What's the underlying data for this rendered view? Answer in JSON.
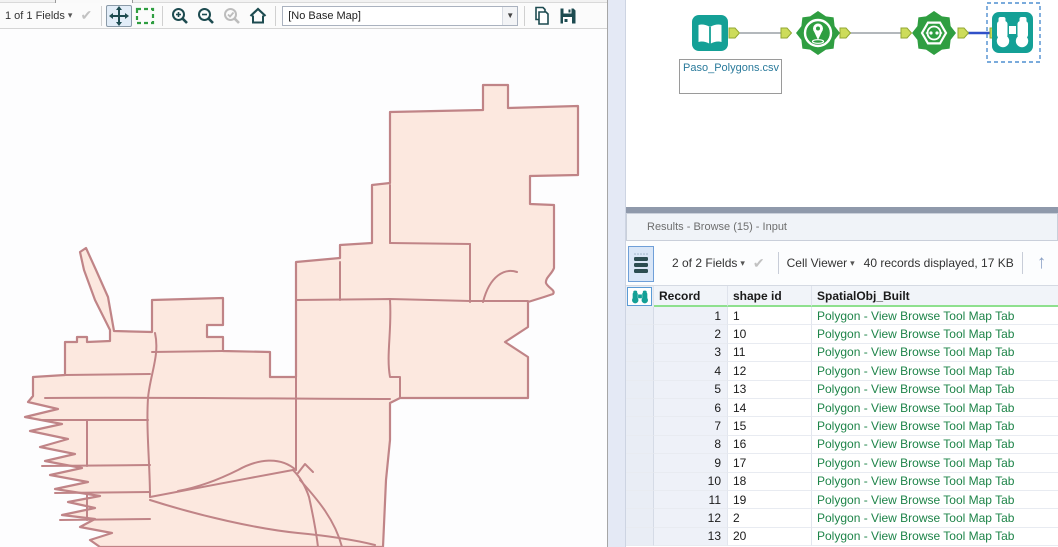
{
  "map_panel": {
    "toolbar": {
      "fields_label": "1 of 1 Fields",
      "caret": "▾",
      "check": "✔",
      "basemap_value": "[No Base Map]"
    },
    "colors": {
      "polygon_fill": "#fce8df",
      "polygon_stroke": "#c08487"
    }
  },
  "workflow": {
    "annotation": {
      "text": "Paso_Polygons.csv"
    },
    "icons": [
      "book-icon",
      "map-pin-icon",
      "poly-build-icon",
      "binoculars-icon"
    ],
    "colors": {
      "tool_teal": "#14a096",
      "tool_green": "#2f9e41",
      "anchor_fill": "#cddc5a",
      "anchor_stroke": "#93a732",
      "connection_gray": "#9aa0a6",
      "connection_blue": "#3050c8",
      "selection_blue": "#4f8fd0"
    }
  },
  "results": {
    "title": "Results - Browse (15) - Input",
    "toolbar": {
      "fields_label": "2 of 2 Fields",
      "caret": "▾",
      "check": "✔",
      "cell_viewer_label": "Cell Viewer",
      "records_info": "40 records displayed, 17 KB",
      "up_arrow": "↑"
    },
    "table": {
      "columns": [
        "Record",
        "shape id",
        "SpatialObj_Built"
      ],
      "spatial_text": "Polygon - View Browse Tool Map Tab",
      "link_color": "#1e8449",
      "rows": [
        {
          "record": "1",
          "shape_id": "1"
        },
        {
          "record": "2",
          "shape_id": "10"
        },
        {
          "record": "3",
          "shape_id": "11"
        },
        {
          "record": "4",
          "shape_id": "12"
        },
        {
          "record": "5",
          "shape_id": "13"
        },
        {
          "record": "6",
          "shape_id": "14"
        },
        {
          "record": "7",
          "shape_id": "15"
        },
        {
          "record": "8",
          "shape_id": "16"
        },
        {
          "record": "9",
          "shape_id": "17"
        },
        {
          "record": "10",
          "shape_id": "18"
        },
        {
          "record": "11",
          "shape_id": "19"
        },
        {
          "record": "12",
          "shape_id": "2"
        },
        {
          "record": "13",
          "shape_id": "20"
        }
      ]
    }
  }
}
